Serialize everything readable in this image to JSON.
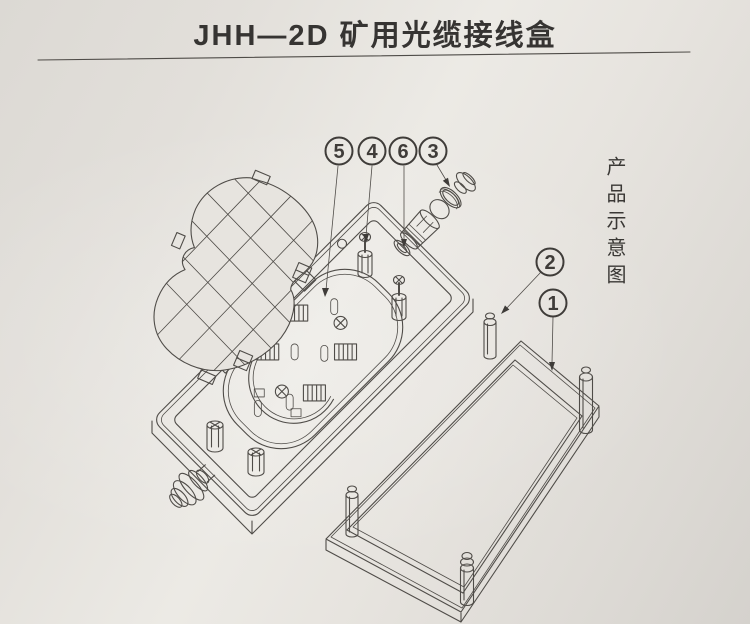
{
  "page": {
    "title": "JHH—2D 矿用光缆接线盒",
    "side_label": "产品示意图"
  },
  "callouts": [
    {
      "label": "5"
    },
    {
      "label": "4"
    },
    {
      "label": "6"
    },
    {
      "label": "3"
    },
    {
      "label": "2"
    },
    {
      "label": "1"
    }
  ],
  "colors": {
    "paper": "#e8e5e0",
    "ink": "#4f4c48",
    "text": "#363432"
  }
}
